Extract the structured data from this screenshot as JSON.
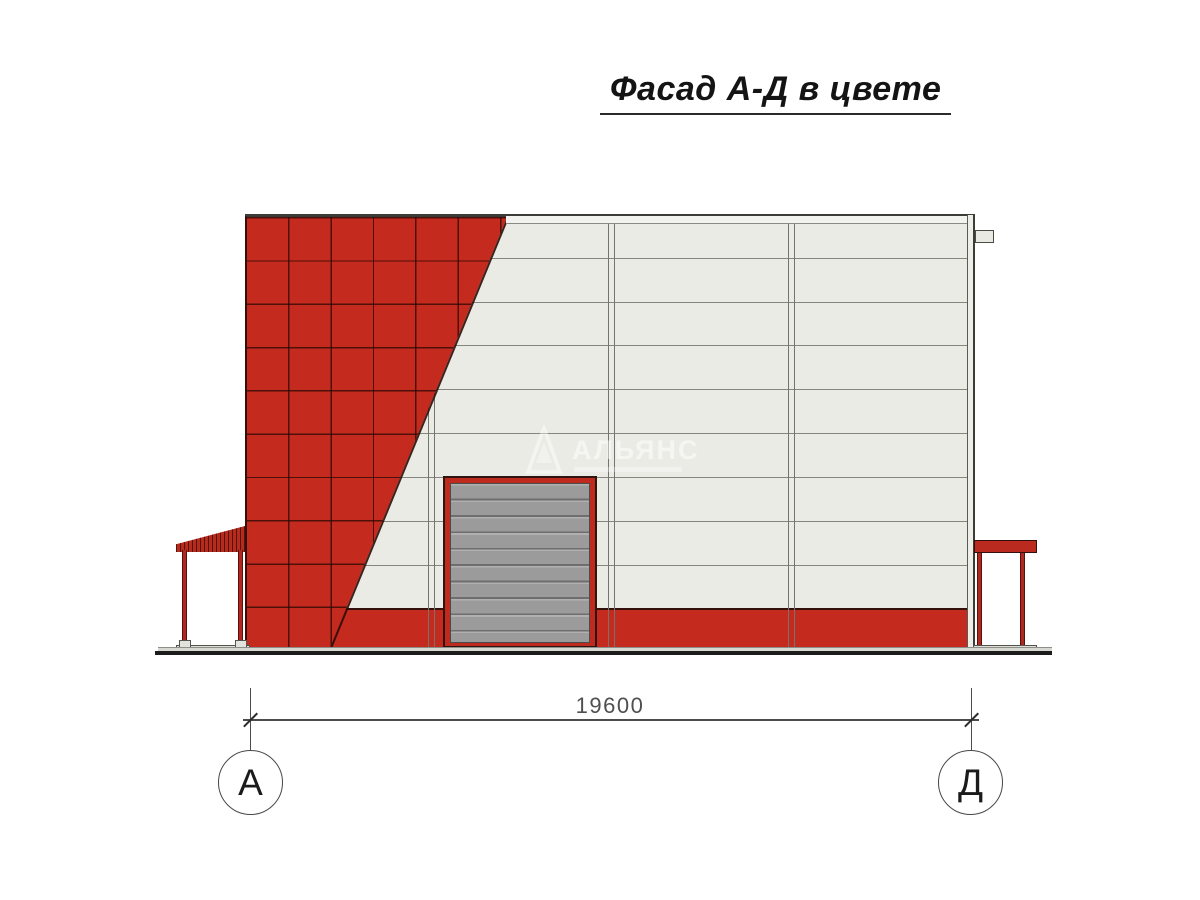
{
  "title": "Фасад А-Д в цвете",
  "drawing": {
    "dimension_label": "19600",
    "axis_left": "А",
    "axis_right": "Д",
    "watermark_text": "АЛЬЯНС"
  },
  "colors": {
    "facade_red": "#c42a1d",
    "wall_light": "#ebebe6",
    "door_gray": "#9b9b9b",
    "outline_dark": "#3c3c38",
    "ground_dark": "#1c1c1c"
  }
}
